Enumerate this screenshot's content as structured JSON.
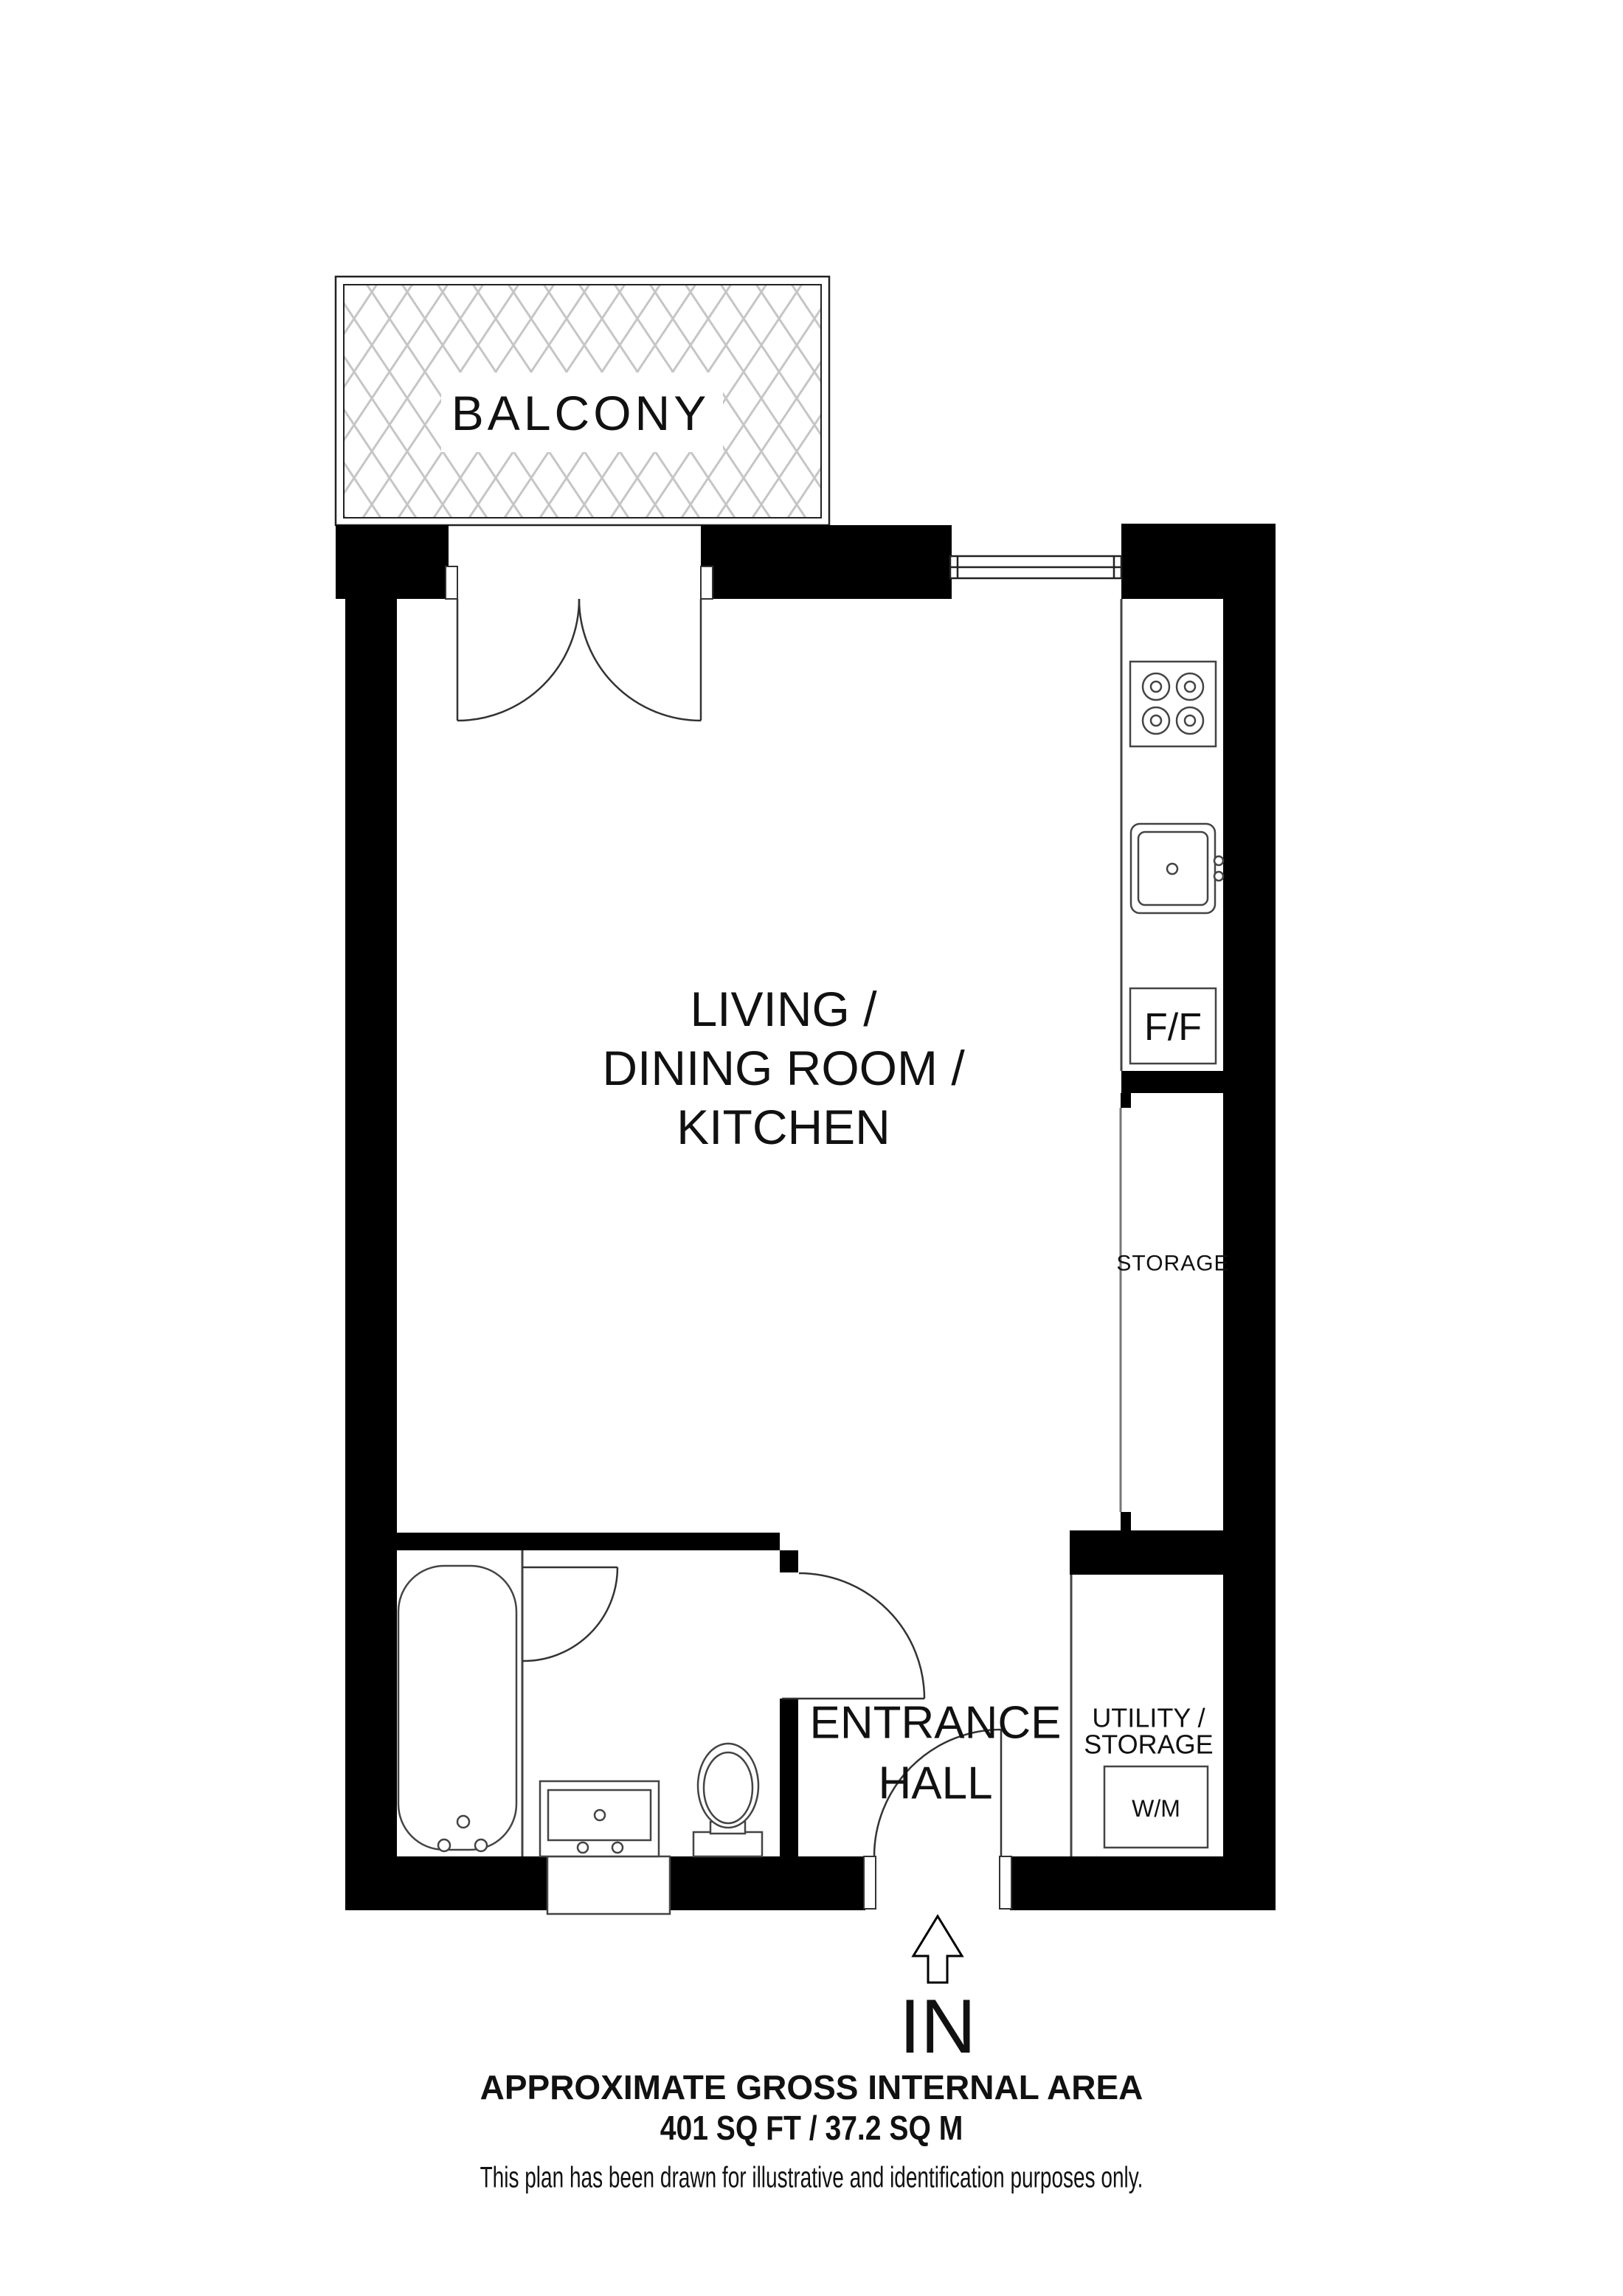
{
  "plan": {
    "balcony_label": "BALCONY",
    "living_room_lines": [
      "LIVING /",
      "DINING ROOM /",
      "KITCHEN"
    ],
    "storage_label": "STORAGE",
    "fridge_freezer_label": "F/F",
    "utility_lines": [
      "UTILITY /",
      "STORAGE"
    ],
    "washing_machine_label": "W/M",
    "entrance_lines": [
      "ENTRANCE",
      "HALL"
    ],
    "entry_label": "IN"
  },
  "footer": {
    "area_title": "APPROXIMATE GROSS INTERNAL AREA",
    "area_value": "401 SQ FT / 37.2 SQ M",
    "disclaimer": "This plan has been drawn for illustrative and identification purposes only."
  },
  "colors": {
    "wall": "#000000",
    "line": "#333333",
    "hatch": "#c6c6c6",
    "background": "#ffffff",
    "text": "#111111"
  }
}
